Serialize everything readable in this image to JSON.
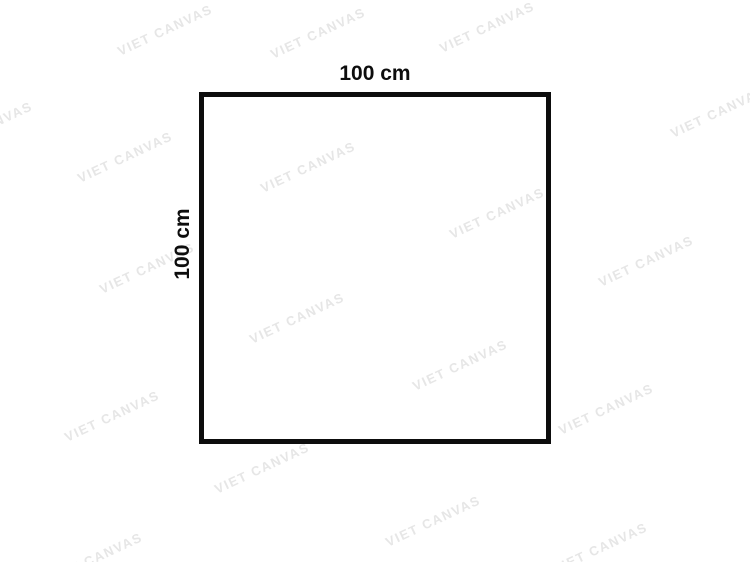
{
  "diagram": {
    "shape": "square",
    "border_color": "#0d0d0d",
    "top_dimension_label": "100 cm",
    "left_dimension_label": "100 cm"
  },
  "watermark": {
    "text": "VIET CANVAS",
    "color": "#e6e6e6",
    "rotation_deg": -25,
    "positions": [
      {
        "x": 165,
        "y": 30
      },
      {
        "x": 318,
        "y": 33
      },
      {
        "x": 487,
        "y": 27
      },
      {
        "x": 718,
        "y": 112
      },
      {
        "x": -15,
        "y": 127
      },
      {
        "x": 125,
        "y": 157
      },
      {
        "x": 308,
        "y": 167
      },
      {
        "x": 497,
        "y": 213
      },
      {
        "x": 646,
        "y": 261
      },
      {
        "x": 147,
        "y": 268
      },
      {
        "x": 297,
        "y": 318
      },
      {
        "x": 460,
        "y": 365
      },
      {
        "x": 112,
        "y": 416
      },
      {
        "x": 606,
        "y": 409
      },
      {
        "x": 262,
        "y": 468
      },
      {
        "x": 433,
        "y": 521
      },
      {
        "x": 95,
        "y": 558
      },
      {
        "x": 600,
        "y": 548
      }
    ]
  }
}
